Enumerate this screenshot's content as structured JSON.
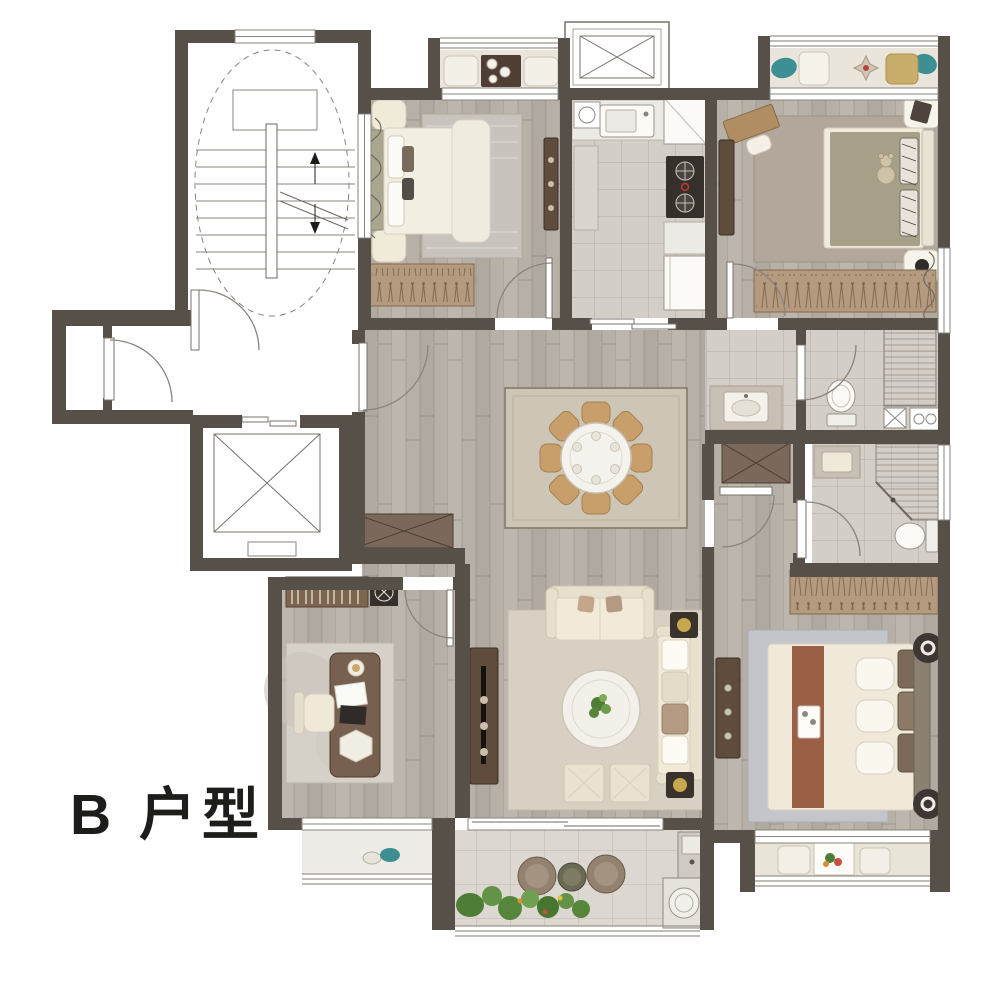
{
  "title": {
    "label": "B 户型"
  },
  "palette": {
    "wall": "#575049",
    "wood_floor": "#b6b0a7",
    "tile_floor": "#d3cec7",
    "balcony_floor": "#e9e4d9",
    "rug_dining": "#cdc5b5",
    "rug_living": "#d8d0c2",
    "sofa_cream": "#f1ead9",
    "dark_wood": "#5f4c3d",
    "wardrobe_tan": "#b49a7f",
    "bed_linen": "#f2ede0",
    "duvet_olive": "#a6a088",
    "bed_runner_brown": "#9b5f46",
    "dining_chair_tan": "#c89f6b",
    "accent_teal": "#3e8f93",
    "plant_green": "#55863c",
    "line_gray": "#8a847e",
    "label_color": "#1d1d1b"
  }
}
